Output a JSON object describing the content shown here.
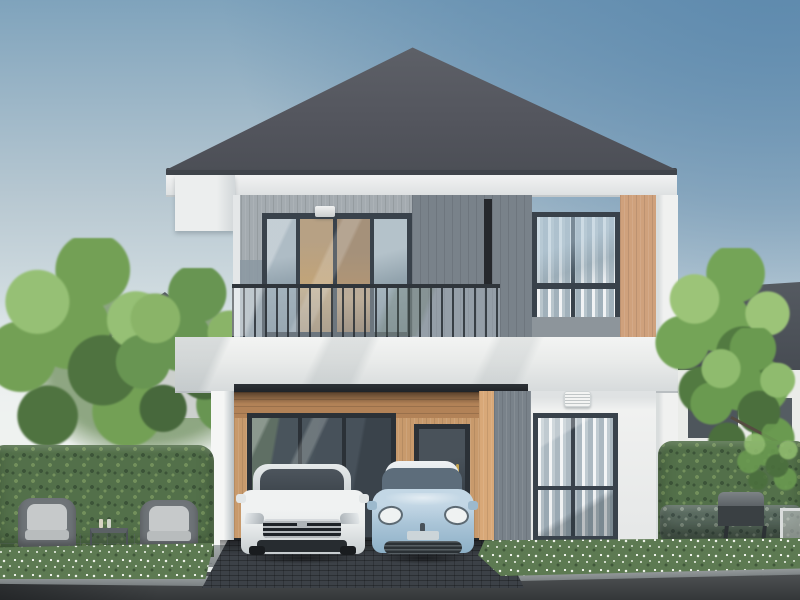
{
  "meta": {
    "title": "Two-storey modern house exterior - 3D architectural rendering",
    "style": "photorealistic daytime render, no visible text"
  },
  "colors": {
    "sky_top": "#7fa3bc",
    "sky_mid": "#b9c9d2",
    "sky_horizon": "#ebefee",
    "sky_accent": "#5d89ad",
    "roof": "#54565e",
    "roof_light": "#5e6168",
    "fascia": "#eceeee",
    "siding_light": "#a4abb0",
    "siding_shade": "#8b98a2",
    "panel_dark": "#79828a",
    "panel_groove": "#25282c",
    "wood_panel": "#cfa17c",
    "carport_wood": "#c89a6c",
    "carport_band": "#b28257",
    "wall_white": "#f0f1f0",
    "parapet": "#e9ebea",
    "frame": "#39424b",
    "frame_dark": "#2b3137",
    "glass_sky": "#b3c1c9",
    "glass_dark": "#47515a",
    "hedge_mid": "#53704a",
    "hedge_dark": "#3c5438",
    "hedge_light": "#73905c",
    "tree_mid": "#73a055",
    "tree_light": "#96c075",
    "tree_dark": "#4f7340",
    "bed_green": "#5d7a52",
    "flower_white": "#eef3ea",
    "road": "#494c4e",
    "road_dark": "#343739",
    "curb": "#989ea0",
    "driveway": "#3c4147",
    "car_white": "#e9ecec",
    "car_blue": "#a9c4d7",
    "car_glass": "#3e464d",
    "chrome": "#ccd1d4",
    "cushion": "#c6c9ca",
    "wicker": "#6f7478",
    "grill_dark": "#3a4043",
    "neighbor_roof": "#4b5157",
    "neighbor_wall": "#ccd0cd",
    "trunk_brown": "#554c41",
    "brass": "#c2a14f"
  },
  "scene": {
    "sky": "clear sky, deeper blue at top right, pale haze near horizon",
    "main_house": {
      "storeys": 2,
      "roof": "dark grey hip roof with horizontal tile ridges and white fascia",
      "facade_materials": [
        "light grey vertical siding (two tones)",
        "dark grey feature panel with recessed groove",
        "warm oak wood-look vertical panels",
        "white render bands and corner column"
      ],
      "second_floor": [
        "balcony with glass railing and slim dark balusters",
        "dark-framed sliding glass doors with warm interior",
        "small wall lamp above doors",
        "dark-framed window at right"
      ],
      "ground_floor": [
        "open double carport with oak-clad rear wall",
        "large dark-framed glazing",
        "glazed front door with brass handle",
        "white louvre vent",
        "dark-framed window with white curtains",
        "white supporting column"
      ]
    },
    "vehicles": [
      {
        "label": "white sedan",
        "details": "dark chrome-barred grille, parked facing viewer under carport"
      },
      {
        "label": "pale blue compact hatchback",
        "details": "white roof, round oval headlights, dark lower grille"
      }
    ],
    "garden": {
      "left": [
        "tall clipped hedge",
        "two grey wicker wing chairs with light cushions",
        "small side table with bottles",
        "white flowering border",
        "light stone patio"
      ],
      "right": [
        "tall clipped hedge",
        "deciduous green tree",
        "black barbecue grill",
        "white garden chair",
        "grey-green shrub row",
        "white flowering border"
      ],
      "front": [
        "dark paved driveway",
        "asphalt road",
        "light kerb stones"
      ]
    },
    "background": [
      "neighbouring house with dark hip roof at left",
      "neighbouring house with dark roof and white walls at right",
      "soft green trees"
    ]
  }
}
